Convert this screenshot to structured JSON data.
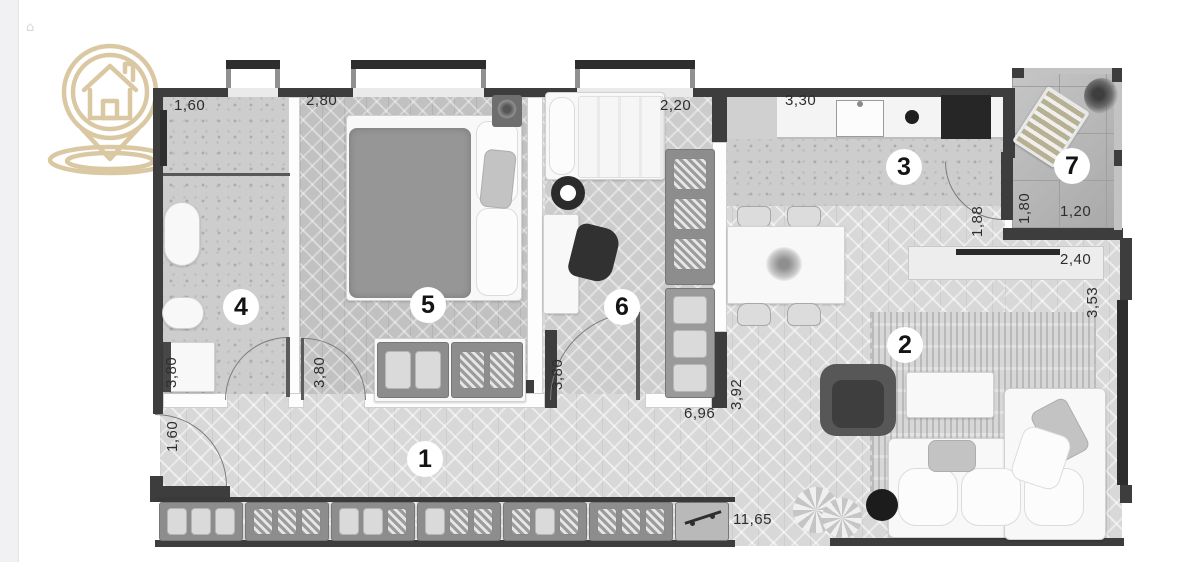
{
  "page": {
    "background": "#ffffff",
    "left_strip_color": "#f1f0f2"
  },
  "corner_mark": {
    "glyph": "⌂"
  },
  "logo": {
    "icon": "house-location-pin",
    "color": "#d9c8a2"
  },
  "floor_plan": {
    "type": "apartment-floor-plan",
    "wall_color": "#3d3d3d",
    "rooms": [
      {
        "number": "1",
        "kind": "hallway"
      },
      {
        "number": "2",
        "kind": "living-room"
      },
      {
        "number": "3",
        "kind": "kitchen"
      },
      {
        "number": "4",
        "kind": "bathroom"
      },
      {
        "number": "5",
        "kind": "bedroom"
      },
      {
        "number": "6",
        "kind": "bedroom-office"
      },
      {
        "number": "7",
        "kind": "balcony"
      }
    ],
    "dimensions": [
      {
        "text": "1,60",
        "edge": "bathroom-top"
      },
      {
        "text": "2,80",
        "edge": "bedroom5-top"
      },
      {
        "text": "2,20",
        "edge": "bedroom6-top"
      },
      {
        "text": "3,30",
        "edge": "kitchen-top"
      },
      {
        "text": "3,80",
        "edge": "bathroom-left"
      },
      {
        "text": "3,80",
        "edge": "bedroom5-left"
      },
      {
        "text": "3,80",
        "edge": "bedroom6-left"
      },
      {
        "text": "1,60",
        "edge": "entry-left"
      },
      {
        "text": "6,96",
        "edge": "hall-upper"
      },
      {
        "text": "3,92",
        "edge": "hall-side"
      },
      {
        "text": "11,65",
        "edge": "hall-bottom"
      },
      {
        "text": "1,88",
        "edge": "kitchen-balcony-door"
      },
      {
        "text": "1,80",
        "edge": "balcony-left"
      },
      {
        "text": "1,20",
        "edge": "balcony-bottom"
      },
      {
        "text": "2,40",
        "edge": "living-sideboard"
      },
      {
        "text": "3,53",
        "edge": "living-window"
      }
    ]
  }
}
